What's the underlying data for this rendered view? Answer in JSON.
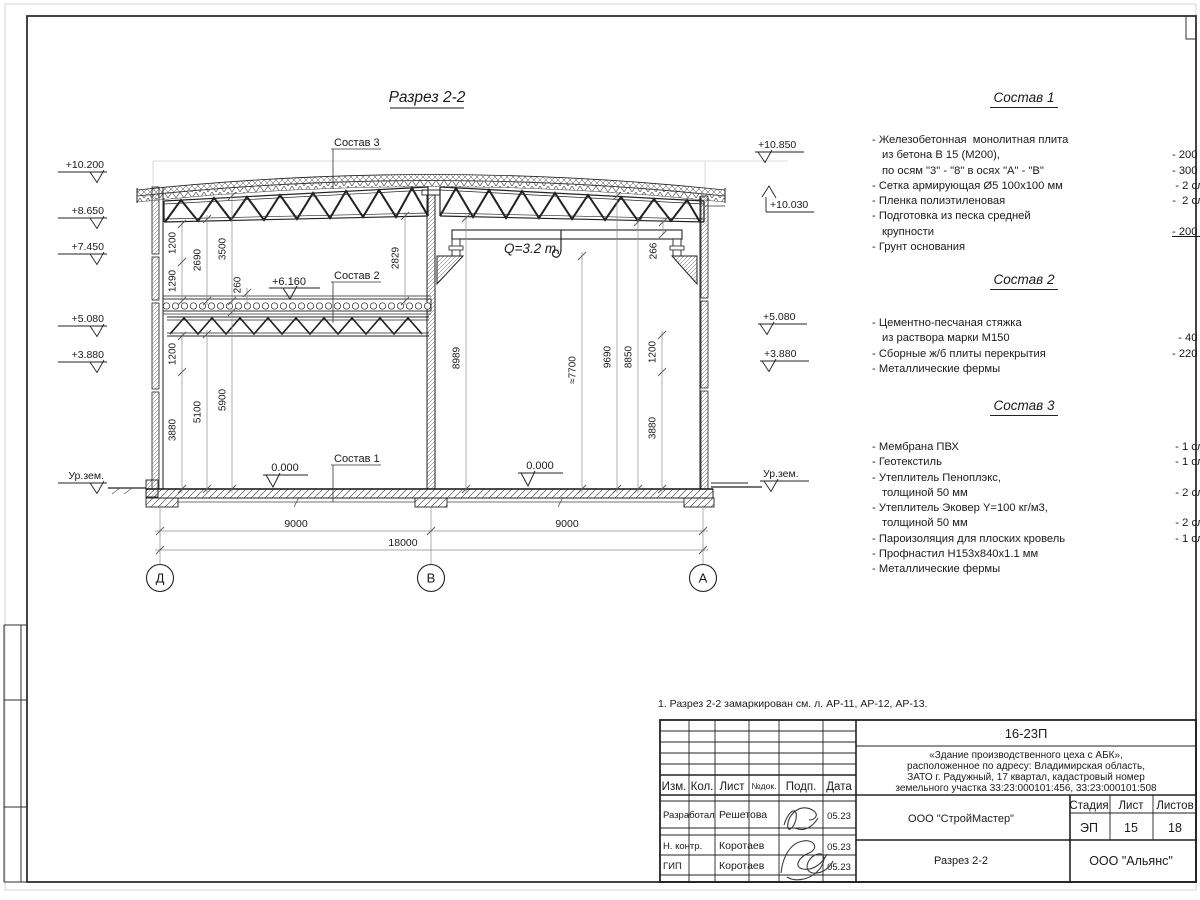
{
  "sheet": {
    "title": "Разрез 2-2",
    "note": "1. Разрез 2-2 замаркирован см. л. АР-11, АР-12, АР-13."
  },
  "section": {
    "labels": {
      "c3": "Состав 3",
      "c2": "Состав 2",
      "c1": "Состав 1",
      "lvl6": "+6.160",
      "zeroL": "0.000",
      "zeroR": "0.000",
      "crane": "Q=3.2 т",
      "groundL": "Ур.зем.",
      "groundR": "Ур.зем."
    },
    "elevL": [
      "+10.200",
      "+8.650",
      "+7.450",
      "+5.080",
      "+3.880"
    ],
    "elevR": [
      "+10.850",
      "+10.030",
      "+5.080",
      "+3.880"
    ],
    "dimsV": [
      "1200",
      "1290",
      "2690",
      "3500",
      "260",
      "1200",
      "3880",
      "5100",
      "5900",
      "2829",
      "8989",
      "≈7700",
      "9690",
      "8850",
      "1200",
      "3880",
      "266"
    ],
    "dimsH": [
      "9000",
      "9000",
      "18000"
    ],
    "axes": [
      "Д",
      "В",
      "А"
    ]
  },
  "comp1": {
    "h": "Состав 1",
    "items": [
      {
        "t": "- Железобетонная  монолитная плита",
        "v": ""
      },
      {
        "t": "из бетона В 15 (М200),",
        "v": "- 200 мм"
      },
      {
        "t": "по осям \"3\" - \"8\" в осях \"А\" - \"В\"",
        "v": "- 300 мм"
      },
      {
        "t": "- Сетка армирующая Ø5 100х100 мм",
        "v": "- 2 слоя"
      },
      {
        "t": "- Пленка полиэтиленовая",
        "v": "-  2 слоя"
      },
      {
        "t": "- Подготовка из песка средней",
        "v": ""
      },
      {
        "t": "крупности",
        "v": "- 200 мм"
      },
      {
        "t": "- Грунт основания",
        "v": ""
      }
    ]
  },
  "comp2": {
    "h": "Состав 2",
    "items": [
      {
        "t": "- Цементно-песчаная стяжка",
        "v": ""
      },
      {
        "t": "из раствора марки М150",
        "v": "- 40 мм"
      },
      {
        "t": "- Сборные ж/б плиты перекрытия",
        "v": "- 220 мм"
      },
      {
        "t": "- Металлические фермы",
        "v": ""
      }
    ]
  },
  "comp3": {
    "h": "Состав 3",
    "items": [
      {
        "t": "- Мембрана ПВХ",
        "v": "- 1 слой"
      },
      {
        "t": "- Геотекстиль",
        "v": "- 1 слой"
      },
      {
        "t": "- Утеплитель Пеноплэкс,",
        "v": ""
      },
      {
        "t": "толщиной 50 мм",
        "v": "- 2 слоя"
      },
      {
        "t": "- Утеплитель Эковер Y=100 кг/м3,",
        "v": ""
      },
      {
        "t": "толщиной 50 мм",
        "v": "- 2 слоя"
      },
      {
        "t": "- Пароизоляция для плоских кровель",
        "v": "- 1 слой"
      },
      {
        "t": "- Профнастил Н153х840х1.1 мм",
        "v": ""
      },
      {
        "t": "- Металлические фермы",
        "v": ""
      }
    ]
  },
  "tb": {
    "code": "16-23П",
    "desc": [
      "«Здание производственного цеха с АБК»,",
      "расположенное по адресу: Владимирская область,",
      "ЗАТО г. Радужный, 17 квартал, кадастровый номер",
      "земельного участка 33:23:000101:456, 33:23:000101:508"
    ],
    "cols": [
      "Изм.",
      "Кол.",
      "Лист",
      "№док.",
      "Подп.",
      "Дата"
    ],
    "rows": [
      {
        "role": "Разработал",
        "name": "Решетова",
        "date": "05.23"
      },
      {
        "role": "Н. контр.",
        "name": "Коротаев",
        "date": "05.23"
      },
      {
        "role": "ГИП",
        "name": "Коротаев",
        "date": "05.23"
      }
    ],
    "designer": "ООО \"СтройМастер\"",
    "stage_h": "Стадия",
    "sheet_h": "Лист",
    "sheets_h": "Листов",
    "stage": "ЭП",
    "sheet_no": "15",
    "sheets_total": "18",
    "dwg": "Разрез 2-2",
    "firm": "ООО \"Альянс\""
  }
}
